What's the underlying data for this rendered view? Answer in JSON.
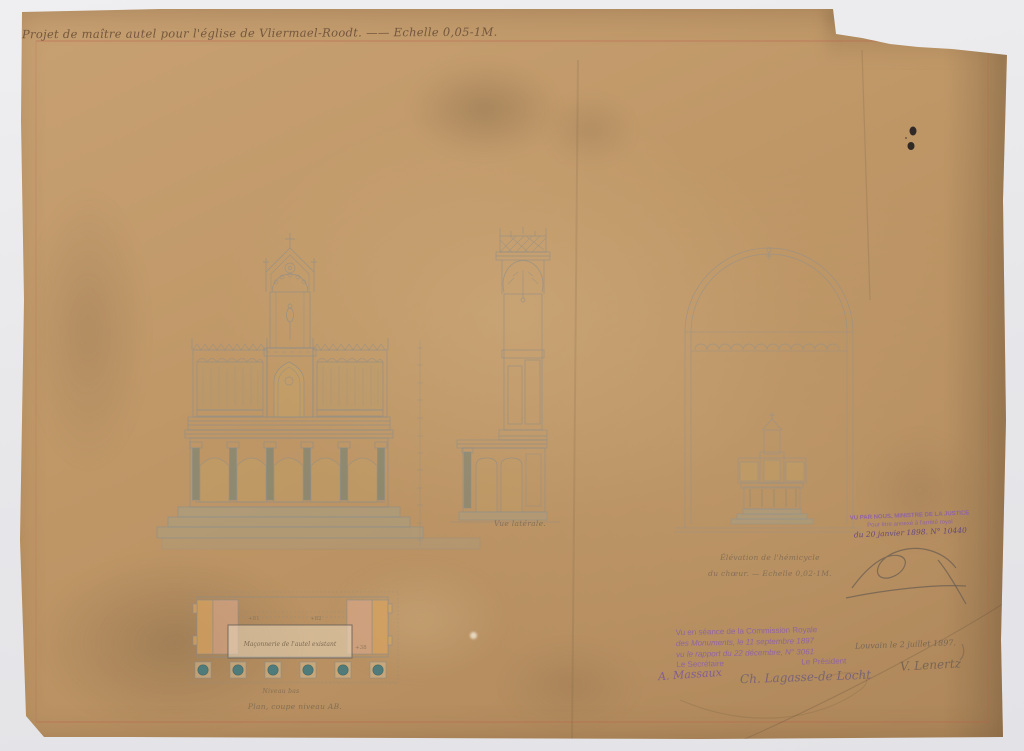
{
  "sheet": {
    "title": "Projet de maître autel pour l'église de Vliermael-Roodt. —— Echelle 0,05-1M."
  },
  "captions": {
    "side_view": "Vue latérale.",
    "hemicycle_line1": "Élévation de l'hémicycle",
    "hemicycle_line2": "du chœur. — Echelle 0,02-1M.",
    "plan_level": "Niveau bas",
    "plan_title": "Plan, coupe niveau AB.",
    "plan_masonry": "Maçonnerie de l'autel existant",
    "plan_marks": [
      "+81",
      "+82",
      "+38"
    ]
  },
  "stamps": {
    "justice": {
      "line1": "VU PAR NOUS, MINISTRE DE LA JUSTICE",
      "line2": "Pour être annexé à l'arrêté royal",
      "line3": "du 20 janvier 1898.  N° 10440"
    },
    "commission": {
      "line1": "Vu en séance de la Commission Royale",
      "line2": "des Monuments, le 11 septembre 1897",
      "line3": "vu le rapport du 22 décembre, N° 3061",
      "secretary_label": "Le Secrétaire",
      "president_label": "Le Président"
    }
  },
  "signatures": {
    "secretary": "A. Massaux",
    "president": "Ch. Lagasse-de Locht",
    "place_date": "Louvain le 2 juillet 1897.",
    "architect": "V. Lenertz"
  },
  "colors": {
    "paper": "#bf9767",
    "background": "#e9e9ec",
    "stamp_purple": "#8a5fae",
    "red_border": "#c0604a",
    "ink_dots": "#242021",
    "plan_teal": "#4f7b7b",
    "plan_pink": "#dba98c",
    "plan_orange": "#d9a35f",
    "wash_gold": "#c5a664",
    "wash_green": "#96aa9e"
  }
}
